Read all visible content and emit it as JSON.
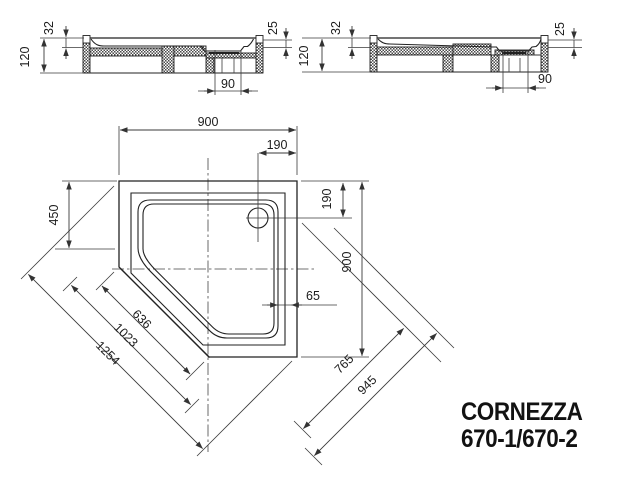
{
  "drawing": {
    "product": {
      "name": "CORNEZZA",
      "models": "670-1/670-2"
    },
    "section_left": {
      "height": "120",
      "rim": "32",
      "depth": "25",
      "drain": "90"
    },
    "section_right": {
      "height": "120",
      "rim": "32",
      "depth": "25",
      "drain": "90"
    },
    "plan": {
      "width": "900",
      "height": "900",
      "drain_x": "190",
      "drain_y": "190",
      "side": "450",
      "rim_width": "65",
      "chamfer": "636",
      "diag_inner": "1023",
      "diag_outer": "1254",
      "cross_inner": "765",
      "cross_outer": "945"
    }
  }
}
